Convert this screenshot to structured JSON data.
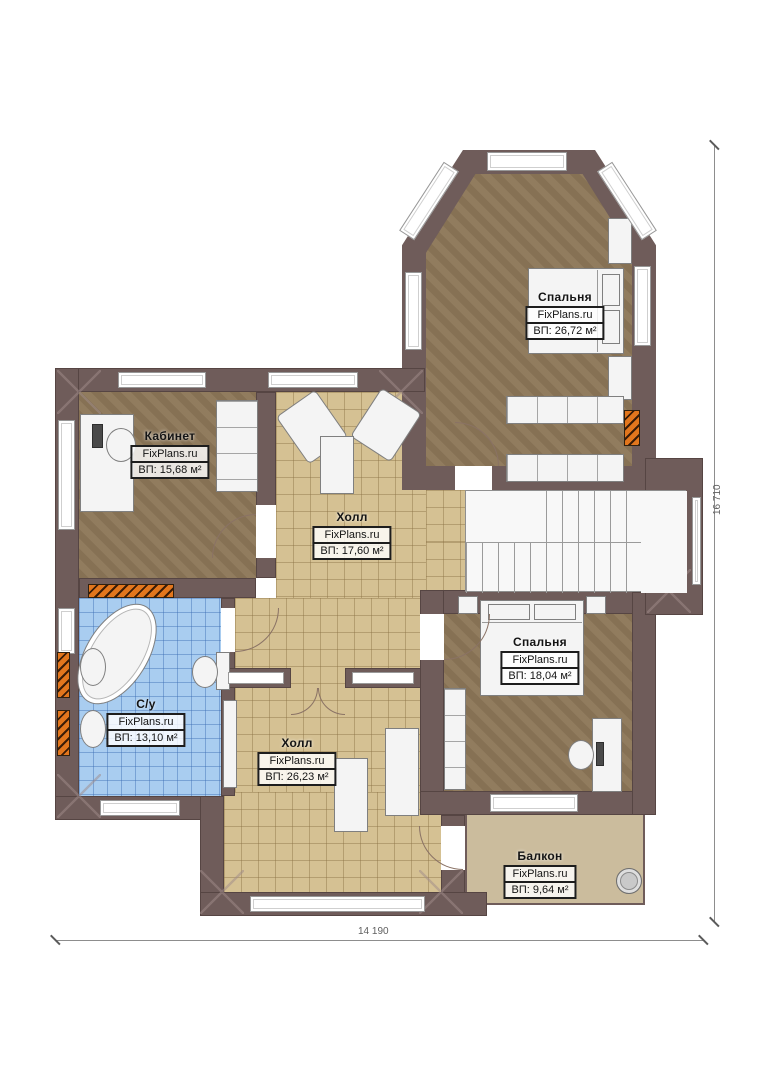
{
  "plan": {
    "watermark": "FixPlans.ru",
    "rooms": [
      {
        "id": "bedroom-top",
        "name": "Спальня",
        "area_label": "ВП: 26,72 м²"
      },
      {
        "id": "office",
        "name": "Кабинет",
        "area_label": "ВП: 15,68 м²"
      },
      {
        "id": "hall-upper",
        "name": "Холл",
        "area_label": "ВП: 17,60 м²"
      },
      {
        "id": "bathroom",
        "name": "С/у",
        "area_label": "ВП: 13,10 м²"
      },
      {
        "id": "hall-lower",
        "name": "Холл",
        "area_label": "ВП: 26,23 м²"
      },
      {
        "id": "bedroom-right",
        "name": "Спальня",
        "area_label": "ВП: 18,04 м²"
      },
      {
        "id": "balcony",
        "name": "Балкон",
        "area_label": "ВП: 9,64 м²"
      }
    ],
    "dimensions": {
      "width_label": "14 190",
      "height_label": "16 710"
    },
    "colors": {
      "wall": "#6f5c5a",
      "wood_floor": "#8d7758",
      "tile_floor": "#d5c193",
      "bath_floor": "#a9cdf0",
      "balcony_floor": "#cbbc9d",
      "radiator": "#e2761d"
    }
  }
}
